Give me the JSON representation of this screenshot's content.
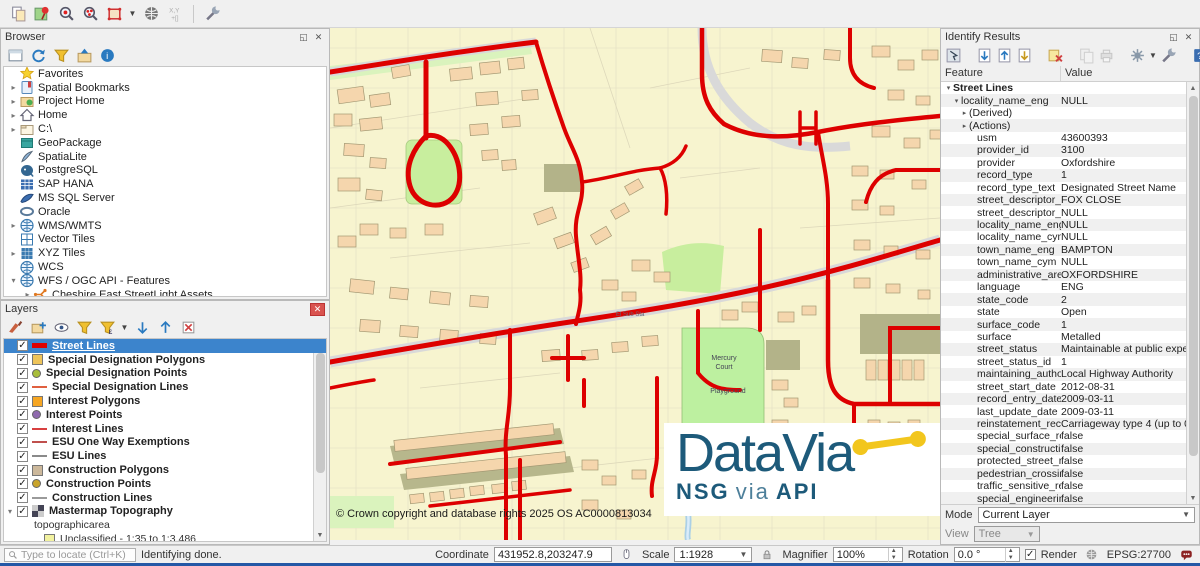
{
  "titles": {
    "browser": "Browser",
    "layers": "Layers",
    "identify": "Identify Results"
  },
  "top_toolbar_icons": [
    "copy-features-icon",
    "pin-icon",
    "zoom-red-icon",
    "identify-red-icon",
    "select-region-icon",
    "dropdown-arrow",
    "globe-icon",
    "xy-capture-icon",
    "sep",
    "wrench-icon"
  ],
  "browser": {
    "toolbar_icons": [
      "add-panel-icon",
      "refresh-icon",
      "funnel-icon",
      "folder-up-icon",
      "info-icon"
    ],
    "items": [
      {
        "label": "Favorites",
        "icon": "favorites-icon",
        "arrow": ""
      },
      {
        "label": "Spatial Bookmarks",
        "icon": "bookmarks-icon",
        "arrow": "▸"
      },
      {
        "label": "Project Home",
        "icon": "project-home-icon",
        "arrow": "▸"
      },
      {
        "label": "Home",
        "icon": "home-icon",
        "arrow": "▸"
      },
      {
        "label": "C:\\",
        "icon": "drive-icon",
        "arrow": "▸"
      },
      {
        "label": "GeoPackage",
        "icon": "geopackage-icon",
        "arrow": ""
      },
      {
        "label": "SpatiaLite",
        "icon": "spatialite-icon",
        "arrow": ""
      },
      {
        "label": "PostgreSQL",
        "icon": "postgres-icon",
        "arrow": ""
      },
      {
        "label": "SAP HANA",
        "icon": "saphana-icon",
        "arrow": ""
      },
      {
        "label": "MS SQL Server",
        "icon": "mssql-icon",
        "arrow": ""
      },
      {
        "label": "Oracle",
        "icon": "oracle-icon",
        "arrow": ""
      },
      {
        "label": "WMS/WMTS",
        "icon": "globe2-icon",
        "arrow": "▸"
      },
      {
        "label": "Vector Tiles",
        "icon": "vectortiles-icon",
        "arrow": ""
      },
      {
        "label": "XYZ Tiles",
        "icon": "xyz-icon",
        "arrow": "▸"
      },
      {
        "label": "WCS",
        "icon": "globe2-icon",
        "arrow": ""
      },
      {
        "label": "WFS / OGC API - Features",
        "icon": "globe2-icon",
        "arrow": "▾"
      },
      {
        "label": "Cheshire East StreetLight Assets",
        "icon": "streetlight-icon",
        "arrow": "▸",
        "indent": 1
      }
    ]
  },
  "layers": {
    "toolbar_icons": [
      "brush-icon",
      "add-group-icon",
      "themes-icon",
      "funnel-icon",
      "expression-icon",
      "dropdown-arrow",
      "expand-tree-icon",
      "collapse-tree-icon",
      "remove-layer-icon"
    ],
    "items": [
      {
        "label": "Street Lines",
        "sym": "thickline",
        "color": "#dd0000",
        "selected": true
      },
      {
        "label": "Special Designation Polygons",
        "sym": "square",
        "color": "#eec45a"
      },
      {
        "label": "Special Designation Points",
        "sym": "circle",
        "color": "#a8bd3a"
      },
      {
        "label": "Special Designation Lines",
        "sym": "line",
        "color": "#e06040"
      },
      {
        "label": "Interest Polygons",
        "sym": "square",
        "color": "#f6a623"
      },
      {
        "label": "Interest Points",
        "sym": "circle",
        "color": "#8f6aae"
      },
      {
        "label": "Interest Lines",
        "sym": "line",
        "color": "#d84040"
      },
      {
        "label": "ESU One Way Exemptions",
        "sym": "line",
        "color": "#c0504d"
      },
      {
        "label": "ESU Lines",
        "sym": "line",
        "color": "#8a8a8a"
      },
      {
        "label": "Construction Polygons",
        "sym": "square",
        "color": "#ccb89b"
      },
      {
        "label": "Construction Points",
        "sym": "circle",
        "color": "#c8a32a"
      },
      {
        "label": "Construction Lines",
        "sym": "line",
        "color": "#9a9a9a"
      },
      {
        "label": "Mastermap Topography",
        "sym": "checker",
        "group": true,
        "arrow": "▾",
        "children": [
          {
            "label": "topographicarea",
            "plain": true
          },
          {
            "label": "Unclassified - 1:35 to 1:3,486",
            "sym": "square",
            "color": "#f2f2a0"
          },
          {
            "label": "Natural surface - 1:35 to 1:3,496",
            "sym": "square",
            "color": "#b8ec9e"
          }
        ]
      }
    ]
  },
  "map": {
    "labels": {
      "place1": "Mercury",
      "place2": "Court",
      "place3": "Playground",
      "substation": "El Sub Sta"
    },
    "copyright": "© Crown copyright and database rights 2025 OS AC0000813034",
    "logo": {
      "title": "DataVia",
      "sub_nsg": "NSG",
      "sub_via": "via",
      "sub_api": "API"
    }
  },
  "identify": {
    "toolbar_icons": [
      "identify-cursor-icon",
      "sep",
      "expand-form-icon",
      "collapse-form-icon",
      "expand-new-icon",
      "sep",
      "clear-results-icon",
      "sep",
      "copy-dis-icon",
      "print-dis-icon",
      "sep",
      "settings-icon",
      "dropdown-arrow",
      "wrench-icon",
      "sep",
      "help-icon"
    ],
    "columns": {
      "feature": "Feature",
      "value": "Value"
    },
    "rows": [
      {
        "f": "Street Lines",
        "v": "",
        "l": 0,
        "a": "▾",
        "b": true
      },
      {
        "f": "locality_name_eng",
        "v": "NULL",
        "l": 1,
        "a": "▾"
      },
      {
        "f": "(Derived)",
        "v": "",
        "l": 2,
        "a": "▸"
      },
      {
        "f": "(Actions)",
        "v": "",
        "l": 2,
        "a": "▸"
      },
      {
        "f": "usm",
        "v": "43600393",
        "l": 3
      },
      {
        "f": "provider_id",
        "v": "3100",
        "l": 3
      },
      {
        "f": "provider",
        "v": "Oxfordshire",
        "l": 3
      },
      {
        "f": "record_type",
        "v": "1",
        "l": 3
      },
      {
        "f": "record_type_text",
        "v": "Designated Street Name",
        "l": 3
      },
      {
        "f": "street_descriptor_e...",
        "v": "FOX CLOSE",
        "l": 3
      },
      {
        "f": "street_descriptor_c...",
        "v": "NULL",
        "l": 3
      },
      {
        "f": "locality_name_eng",
        "v": "NULL",
        "l": 3
      },
      {
        "f": "locality_name_cym",
        "v": "NULL",
        "l": 3
      },
      {
        "f": "town_name_eng",
        "v": "BAMPTON",
        "l": 3
      },
      {
        "f": "town_name_cym",
        "v": "NULL",
        "l": 3
      },
      {
        "f": "administrative_area",
        "v": "OXFORDSHIRE",
        "l": 3
      },
      {
        "f": "language",
        "v": "ENG",
        "l": 3
      },
      {
        "f": "state_code",
        "v": "2",
        "l": 3
      },
      {
        "f": "state",
        "v": "Open",
        "l": 3
      },
      {
        "f": "surface_code",
        "v": "1",
        "l": 3
      },
      {
        "f": "surface",
        "v": "Metalled",
        "l": 3
      },
      {
        "f": "street_status",
        "v": "Maintainable at public expen...",
        "l": 3
      },
      {
        "f": "street_status_id",
        "v": "1",
        "l": 3
      },
      {
        "f": "maintaining_autho...",
        "v": "Local Highway Authority",
        "l": 3
      },
      {
        "f": "street_start_date",
        "v": "2012-08-31",
        "l": 3
      },
      {
        "f": "record_entry_date",
        "v": "2009-03-11",
        "l": 3
      },
      {
        "f": "last_update_date",
        "v": "2009-03-11",
        "l": 3
      },
      {
        "f": "reinstatement_rec...",
        "v": "Carriageway type 4 (up to 0...",
        "l": 3
      },
      {
        "f": "special_surface_re...",
        "v": "false",
        "l": 3
      },
      {
        "f": "special_constructi...",
        "v": "false",
        "l": 3
      },
      {
        "f": "protected_street_r...",
        "v": "false",
        "l": 3
      },
      {
        "f": "pedestrian_crossin...",
        "v": "false",
        "l": 3
      },
      {
        "f": "traffic_sensitive_re...",
        "v": "false",
        "l": 3
      },
      {
        "f": "special_engineerin...",
        "v": "false",
        "l": 3
      }
    ],
    "mode": {
      "label": "Mode",
      "value": "Current Layer"
    },
    "view": {
      "label": "View",
      "value": "Tree"
    }
  },
  "statusbar": {
    "locate_placeholder": "Type to locate (Ctrl+K)",
    "message": "Identifying done.",
    "coordinate_label": "Coordinate",
    "coordinate_value": "431952.8,203247.9",
    "scale_label": "Scale",
    "scale_value": "1:1928",
    "magnifier_label": "Magnifier",
    "magnifier_value": "100%",
    "rotation_label": "Rotation",
    "rotation_value": "0.0 °",
    "render_label": "Render",
    "crs": "EPSG:27700"
  },
  "colors": {
    "street_red": "#dd0000",
    "selection_blue": "#3c84cc",
    "logo_blue": "#1d5a7a",
    "logo_yellow": "#f2c61d"
  }
}
